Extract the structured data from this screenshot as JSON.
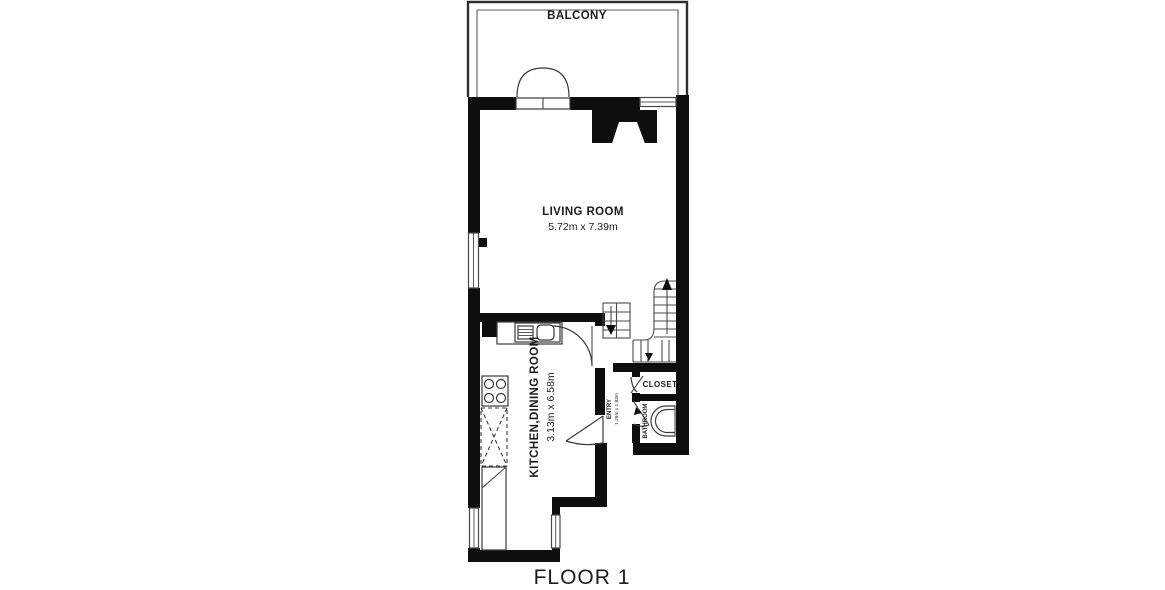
{
  "page": {
    "background": "#ffffff",
    "type": "floor-plan"
  },
  "colors": {
    "wall": "#0e0e0e",
    "thin_line": "#4a4a4a",
    "text": "#1c1c1c",
    "background": "#ffffff"
  },
  "floor": {
    "label": "FLOOR 1"
  },
  "rooms": {
    "balcony": {
      "label": "BALCONY"
    },
    "living": {
      "label": "LIVING ROOM",
      "dims": "5.72m x 7.39m"
    },
    "kitchen": {
      "label": "KITCHEN,DINING ROOM",
      "dims": "3.13m x 6.58m"
    },
    "closet": {
      "label": "CLOSET"
    },
    "bathroom": {
      "label": "BATHROOM"
    },
    "entry": {
      "label": "ENTRY",
      "dims": "1.29m x 1.83m"
    }
  }
}
